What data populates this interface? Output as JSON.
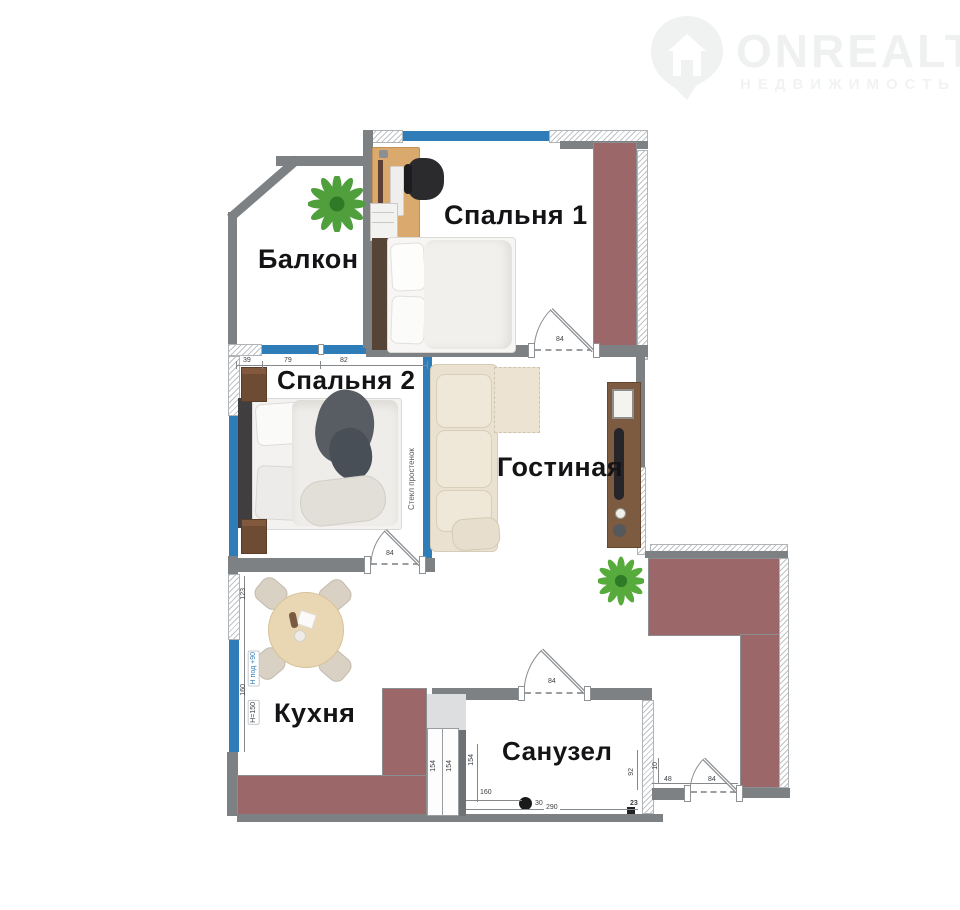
{
  "brand": {
    "name": "ONREALT",
    "subtitle": "НЕДВИЖИМОСТЬ",
    "icon": "house-pin-icon"
  },
  "rooms": {
    "bedroom1": "Спальня 1",
    "balcony": "Балкон",
    "bedroom2": "Спальня 2",
    "living_room": "Гостиная",
    "kitchen": "Кухня",
    "bathroom": "Санузел"
  },
  "annotations": {
    "glass_partition": "Стекл простенок",
    "kitchen_height_note": "H=150",
    "kitchen_sill_note": "Н под +90"
  },
  "dimensions": {
    "bedroom2_window": [
      "39",
      "79",
      "82"
    ],
    "kitchen_left": [
      "123",
      "160"
    ],
    "door_bedroom1": "84",
    "door_bedroom2": "84",
    "door_bathroom": "84",
    "door_entrance": "84",
    "entrance_side": "48",
    "entrance_depth": "92",
    "entrance_small": "10",
    "entrance_corner": "23",
    "bathroom_cabinet": [
      "154",
      "154"
    ],
    "bathroom_wall": "154",
    "bathroom_width": "160",
    "bathroom_drain_offset": "30",
    "bathroom_length": "290"
  },
  "icons": {
    "brand": "house-pin-icon",
    "plants": "potted-plant-icon",
    "drain": "floor-drain-icon"
  },
  "colors": {
    "wall_gray": "#7d8184",
    "wall_accent_maroon": "#9c6768",
    "window_blue": "#2e7cb8",
    "label_text": "#141416",
    "watermark_gray": "#eff1f1",
    "wood": "#d9a96e",
    "sofa_cream": "#eae1d0"
  }
}
